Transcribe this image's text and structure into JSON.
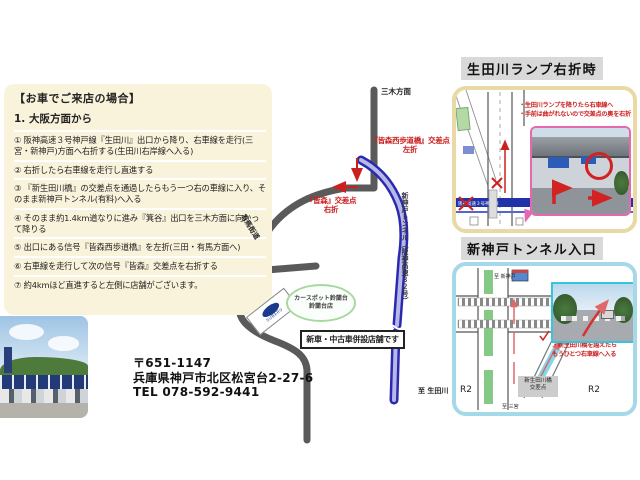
{
  "directions": {
    "heading": "【お車でご来店の場合】",
    "subheading": "1. 大阪方面から",
    "steps": [
      "① 阪神高速３号神戸線『生田川』出口から降り、右車線を走行(三宮・新神戸)方面へ右折する(生田川右岸線へ入る)",
      "② 右折したら右車線を走行し直進する",
      "③ 『新生田川橋』の交差点を通過したらもう一つ右の車線に入り、そのまま新神戸トンネル(有料)へ入る",
      "④ そのまま約1.4km道なりに進み『箕谷』出口を三木方面に向かって降りる",
      "⑤ 出口にある信号『皆森西歩道橋』を左折(三田・有馬方面へ)",
      "⑥ 右車線を走行して次の信号『皆森』交差点を右折する",
      "⑦ 約4kmほど直進すると左側に店舗がございます。"
    ]
  },
  "map": {
    "miki_label": "三木方面",
    "arima_kaido_label": "有馬街道",
    "tunnel_label": "新神戸トンネル（阪神高速３２号）",
    "to_ikutagawa_label": "至 生田川",
    "minamori_west_label": "『皆森西歩道橋』交差点",
    "minamori_west_action": "左折",
    "minamori_label": "『皆森』交差点",
    "minamori_action": "右折",
    "dealer_callout_line1": "カースポット鈴蘭台",
    "dealer_callout_line2": "鈴蘭台店",
    "dealer_logo": "SUBARU",
    "shop_note": "新車・中古車併設店舗です"
  },
  "panel_ikutagawa": {
    "title": "生田川ランプ右折時",
    "note1": "・生田川ランプを降りたら右車線へ",
    "note2": "・手前は曲がれないので交差点の奥を右折",
    "exit_label": "『生田川』出口",
    "exit_action": "右折",
    "highway_label_left": "阪神高速３号神戸線",
    "highway_label_right": "阪神高速３号神戸線"
  },
  "panel_tunnel": {
    "title": "新神戸トンネル入口",
    "note1": "・新生田川橋を越えたら",
    "note2": "もうひとつ右車線へ入る",
    "intersection_line1": "新生田川橋",
    "intersection_line2": "交差点",
    "r2_left": "R2",
    "r2_right": "R2",
    "to_shinkobe": "至 新神戸",
    "to_sannomiya": "至 三宮"
  },
  "address": {
    "postal": "〒651-1147",
    "street": "兵庫県神戸市北区松宮台2-27-6",
    "tel": "TEL 078-592-9441"
  },
  "colors": {
    "cream_panel": "#faf3dc",
    "panel1_border": "#e9d9a5",
    "panel2_border": "#a5d8e8",
    "road_gray": "#5a5a5a",
    "road_blue": "#2a2ab0",
    "annotation_red": "#cc2020",
    "title_bg": "#d9d9d9"
  }
}
